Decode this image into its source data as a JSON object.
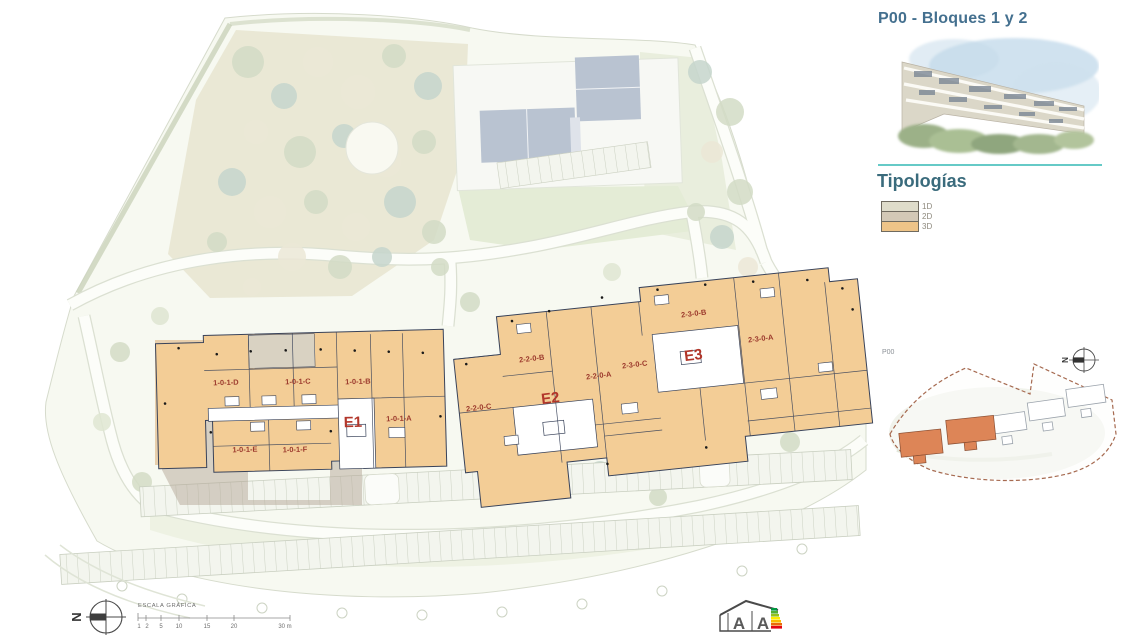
{
  "panel": {
    "title": "P00 - Bloques 1 y 2",
    "typologies_heading": "Tipologías",
    "typologies": [
      {
        "label": "1D",
        "color": "#dfdcca"
      },
      {
        "label": "2D",
        "color": "#d3c8b6"
      },
      {
        "label": "3D",
        "color": "#eec488"
      }
    ]
  },
  "plan": {
    "e1": {
      "name": "E1",
      "unit_d": "1-0-1-D",
      "unit_c": "1-0-1-C",
      "unit_b": "1-0-1-B",
      "unit_a": "1-0-1-A",
      "unit_e": "1-0-1-E",
      "unit_f": "1-0-1-F"
    },
    "e2": {
      "name": "E2",
      "unit_b": "2-2-0-B",
      "unit_a": "2-2-0-A",
      "unit_c": "2-2-0-C"
    },
    "e3": {
      "name": "E3",
      "unit_c": "2-3-0-C",
      "unit_b": "2-3-0-B",
      "unit_a": "2-3-0-A"
    },
    "building_fill": "#f3cd96",
    "outline_color": "#39435a",
    "label_color": "#9c3a2d"
  },
  "keymap": {
    "label": "P00",
    "north": "N",
    "highlight_color": "#dd8557"
  },
  "scale": {
    "title": "ESCALA GRÁFICA",
    "ticks": [
      "1",
      "2",
      "5",
      "10",
      "15",
      "20",
      "30 m"
    ]
  },
  "compass": {
    "north": "N"
  },
  "energy": {
    "letter_left": "A",
    "letter_right": "A"
  }
}
